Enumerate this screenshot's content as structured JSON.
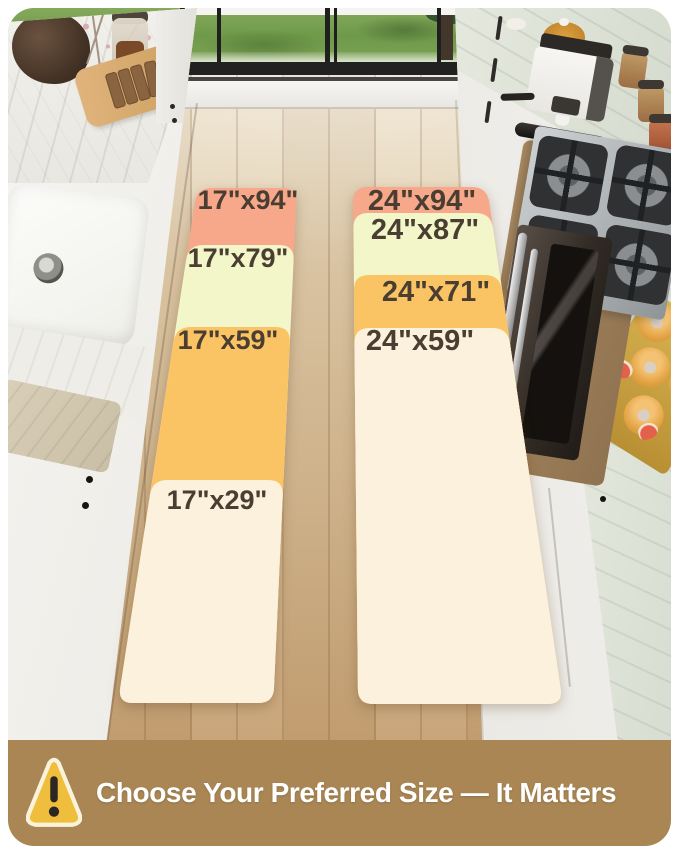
{
  "rugs": {
    "label_color": "#4A3E33",
    "left": {
      "bands": [
        {
          "label": "17\"x94\"",
          "color": "#F7A88B"
        },
        {
          "label": "17\"x79\"",
          "color": "#F2F6C9"
        },
        {
          "label": "17\"x59\"",
          "color": "#FAC464"
        },
        {
          "label": "17\"x29\"",
          "color": "#FBF1DC"
        }
      ]
    },
    "right": {
      "bands": [
        {
          "label": "24\"x94\"",
          "color": "#F7A88B"
        },
        {
          "label": "24\"x87\"",
          "color": "#F2F6C9"
        },
        {
          "label": "24\"x71\"",
          "color": "#FAC464"
        },
        {
          "label": "24\"x59\"",
          "color": "#FBF1DC"
        }
      ]
    }
  },
  "banner": {
    "text": "Choose Your Preferred Size — It Matters",
    "background": "#A98653",
    "text_color": "#FFFFFF",
    "icon": "warning-triangle",
    "icon_fill": "#EFBE3D",
    "icon_border": "#FAF3DC",
    "icon_mark_color": "#2B2723"
  },
  "scene": {
    "floor_wood": "#D9BE98",
    "grass_green": "#6F9A4A",
    "marble": "#EDEBE5",
    "stainless": "#AEB3B6"
  }
}
